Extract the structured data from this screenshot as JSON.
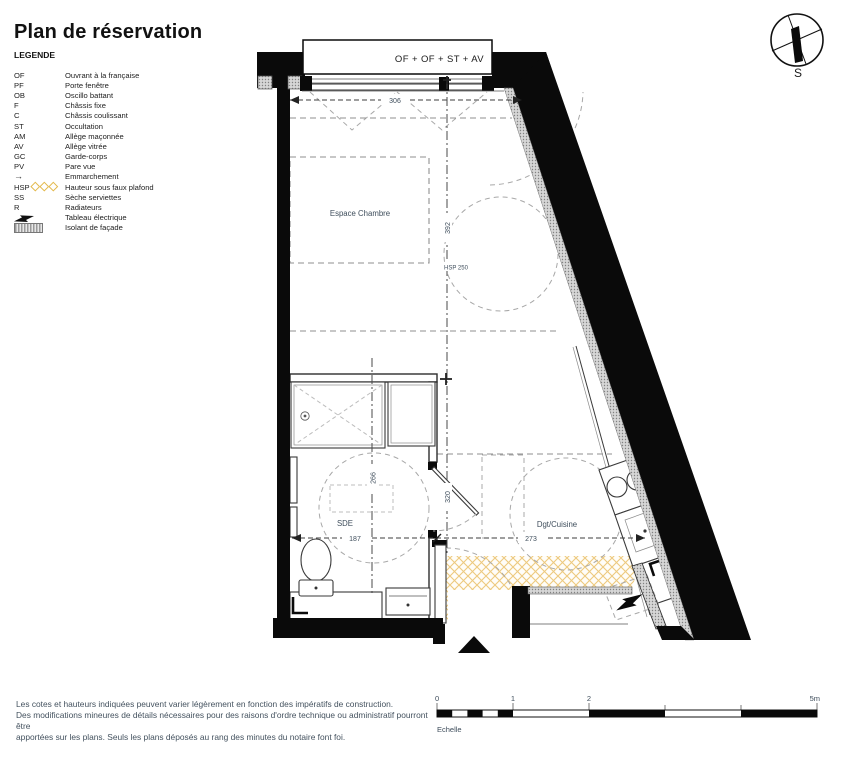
{
  "title": "Plan de réservation",
  "legend": {
    "heading": "LEGENDE",
    "items": [
      {
        "abbr": "OF",
        "label": "Ouvrant à la française"
      },
      {
        "abbr": "PF",
        "label": "Porte fenêtre"
      },
      {
        "abbr": "OB",
        "label": "Oscillo battant"
      },
      {
        "abbr": "F",
        "label": "Châssis fixe"
      },
      {
        "abbr": "C",
        "label": "Châssis coulissant"
      },
      {
        "abbr": "ST",
        "label": "Occultation"
      },
      {
        "abbr": "AM",
        "label": "Allège maçonnée"
      },
      {
        "abbr": "AV",
        "label": "Allège vitrée"
      },
      {
        "abbr": "GC",
        "label": "Garde-corps"
      },
      {
        "abbr": "PV",
        "label": "Pare vue"
      },
      {
        "abbr": "→",
        "label": "Emmarchement",
        "icon": "arrow-right-icon"
      },
      {
        "abbr": "HSP",
        "label": "Hauteur sous faux plafond",
        "icon": "hsp-diamonds-icon"
      },
      {
        "abbr": "SS",
        "label": "Sèche serviettes"
      },
      {
        "abbr": "R",
        "label": "Radiateurs"
      },
      {
        "abbr": "",
        "label": "Tableau électrique",
        "icon": "lightning-icon"
      },
      {
        "abbr": "",
        "label": "Isolant de façade",
        "icon": "facade-insulation-swatch"
      }
    ]
  },
  "compass": {
    "south_label": "S"
  },
  "plan": {
    "window_label": "OF + OF + ST + AV",
    "rooms": {
      "chambre": "Espace Chambre",
      "sde": "SDE",
      "cuisine": "Dgt/Cuisine"
    },
    "dimensions": {
      "width_top": "306",
      "depth_chambre": "392",
      "hsp": "HSP 250",
      "sde_depth": "266",
      "sde_width": "187",
      "hall_depth": "320",
      "cuisine_width": "273"
    }
  },
  "scalebar": {
    "tick0": "0",
    "tick1": "1",
    "tick2": "2",
    "tick5": "5m",
    "caption": "Echelle"
  },
  "footer": {
    "lines": [
      "Les cotes et hauteurs indiquées peuvent varier légèrement en fonction des impératifs de construction.",
      "Des modifications mineures de détails nécessaires pour des raisons d'ordre technique ou administratif pourront être",
      "apportées sur les plans. Seuls les plans déposés au rang des minutes du notaire font foi."
    ]
  },
  "colors": {
    "wall": "#0a0a0a",
    "hsp_yellow": "#edc97e",
    "insulation_gray": "#d6d6d6",
    "annotation_text": "#3f4e5c"
  }
}
